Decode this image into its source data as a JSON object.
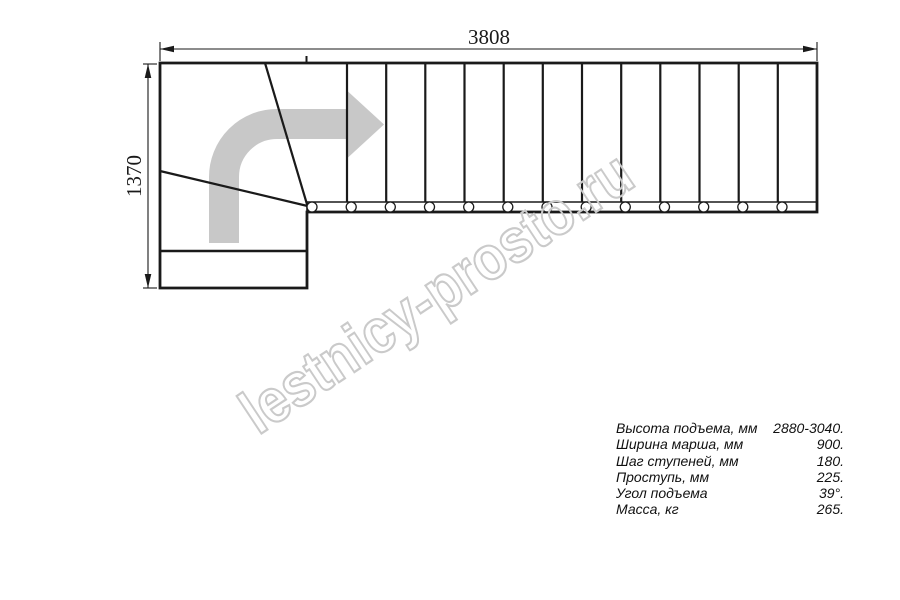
{
  "drawing": {
    "dim_width": "3808",
    "dim_height": "1370",
    "colors": {
      "line": "#1a1a1a",
      "arrow": "#c8c8c8",
      "watermark": "#cacaca"
    }
  },
  "watermark": {
    "text": "lestnicy-prosto.ru"
  },
  "specs": {
    "rows": [
      {
        "label": "Высота подъема, мм",
        "value": "2880-3040."
      },
      {
        "label": "Ширина марша, мм",
        "value": "900."
      },
      {
        "label": "Шаг ступеней, мм",
        "value": "180."
      },
      {
        "label": "Проступь, мм",
        "value": "225."
      },
      {
        "label": "Угол подъема",
        "value": "39°."
      },
      {
        "label": "Масса, кг",
        "value": "265."
      }
    ]
  }
}
